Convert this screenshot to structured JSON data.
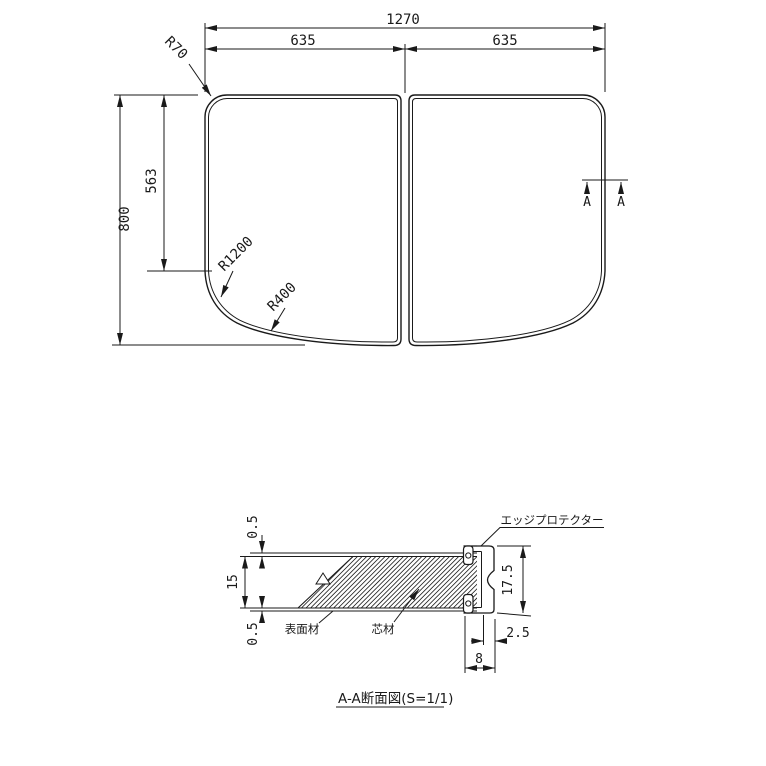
{
  "drawing": {
    "colors": {
      "line": "#1a1a1a",
      "background": "#ffffff"
    },
    "plan_view": {
      "dim_width_total": "1270",
      "dim_width_left": "635",
      "dim_width_right": "635",
      "dim_height_total": "800",
      "dim_height_partial": "563",
      "radius_top_corner": "R70",
      "radius_side_curve": "R1200",
      "radius_bottom_curve": "R400",
      "section_marker_left": "A",
      "section_marker_right": "A"
    },
    "section_view": {
      "dim_surface_top": "0.5",
      "dim_core_thickness": "15",
      "dim_surface_bottom": "0.5",
      "dim_protector_height": "17.5",
      "dim_protector_wall": "2.5",
      "dim_protector_width": "8",
      "label_surface_material": "表面材",
      "label_core_material": "芯材",
      "label_edge_protector": "エッジプロテクター",
      "title": "A-A断面図(S=1/1)"
    }
  }
}
